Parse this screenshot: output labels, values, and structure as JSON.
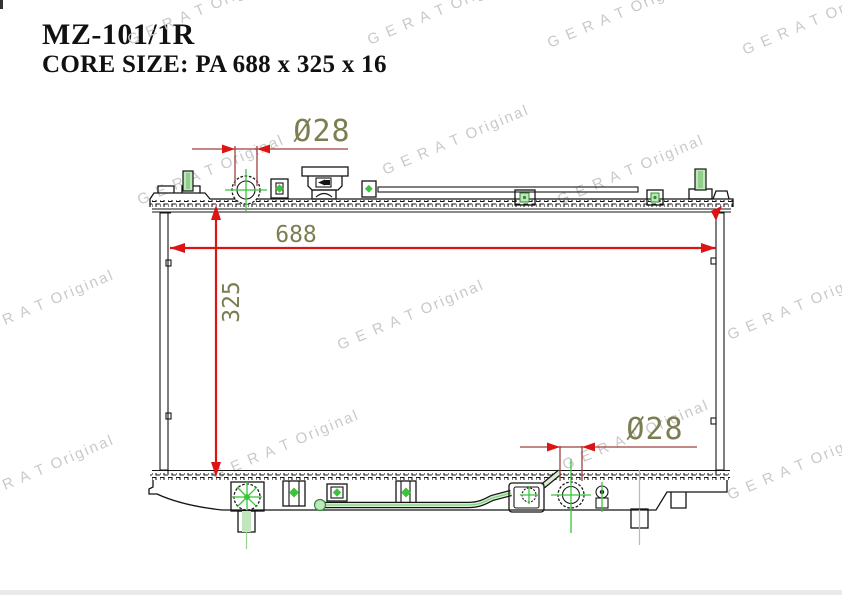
{
  "header": {
    "part_number": "MZ-101/1R",
    "core_size": "CORE SIZE: PA 688 x 325 x 16"
  },
  "watermark": {
    "text": "G E R A T Original",
    "color": "#c9c9c9"
  },
  "dimensions": {
    "core_width": "688",
    "core_height": "325",
    "inlet_diameter": "Ø28",
    "outlet_diameter": "Ø28"
  },
  "colors": {
    "drawing_line": "#151515",
    "dimension_arrow_red": "#dd1414",
    "dimension_line_dark_red": "#9e4040",
    "dimension_text_olive": "#7d7d52",
    "detail_green": "#2e8b2e",
    "centerline_green": "#3bc43b",
    "detail_green_light": "#bfe6bc",
    "watermark_gray": "#c9c9c9"
  }
}
